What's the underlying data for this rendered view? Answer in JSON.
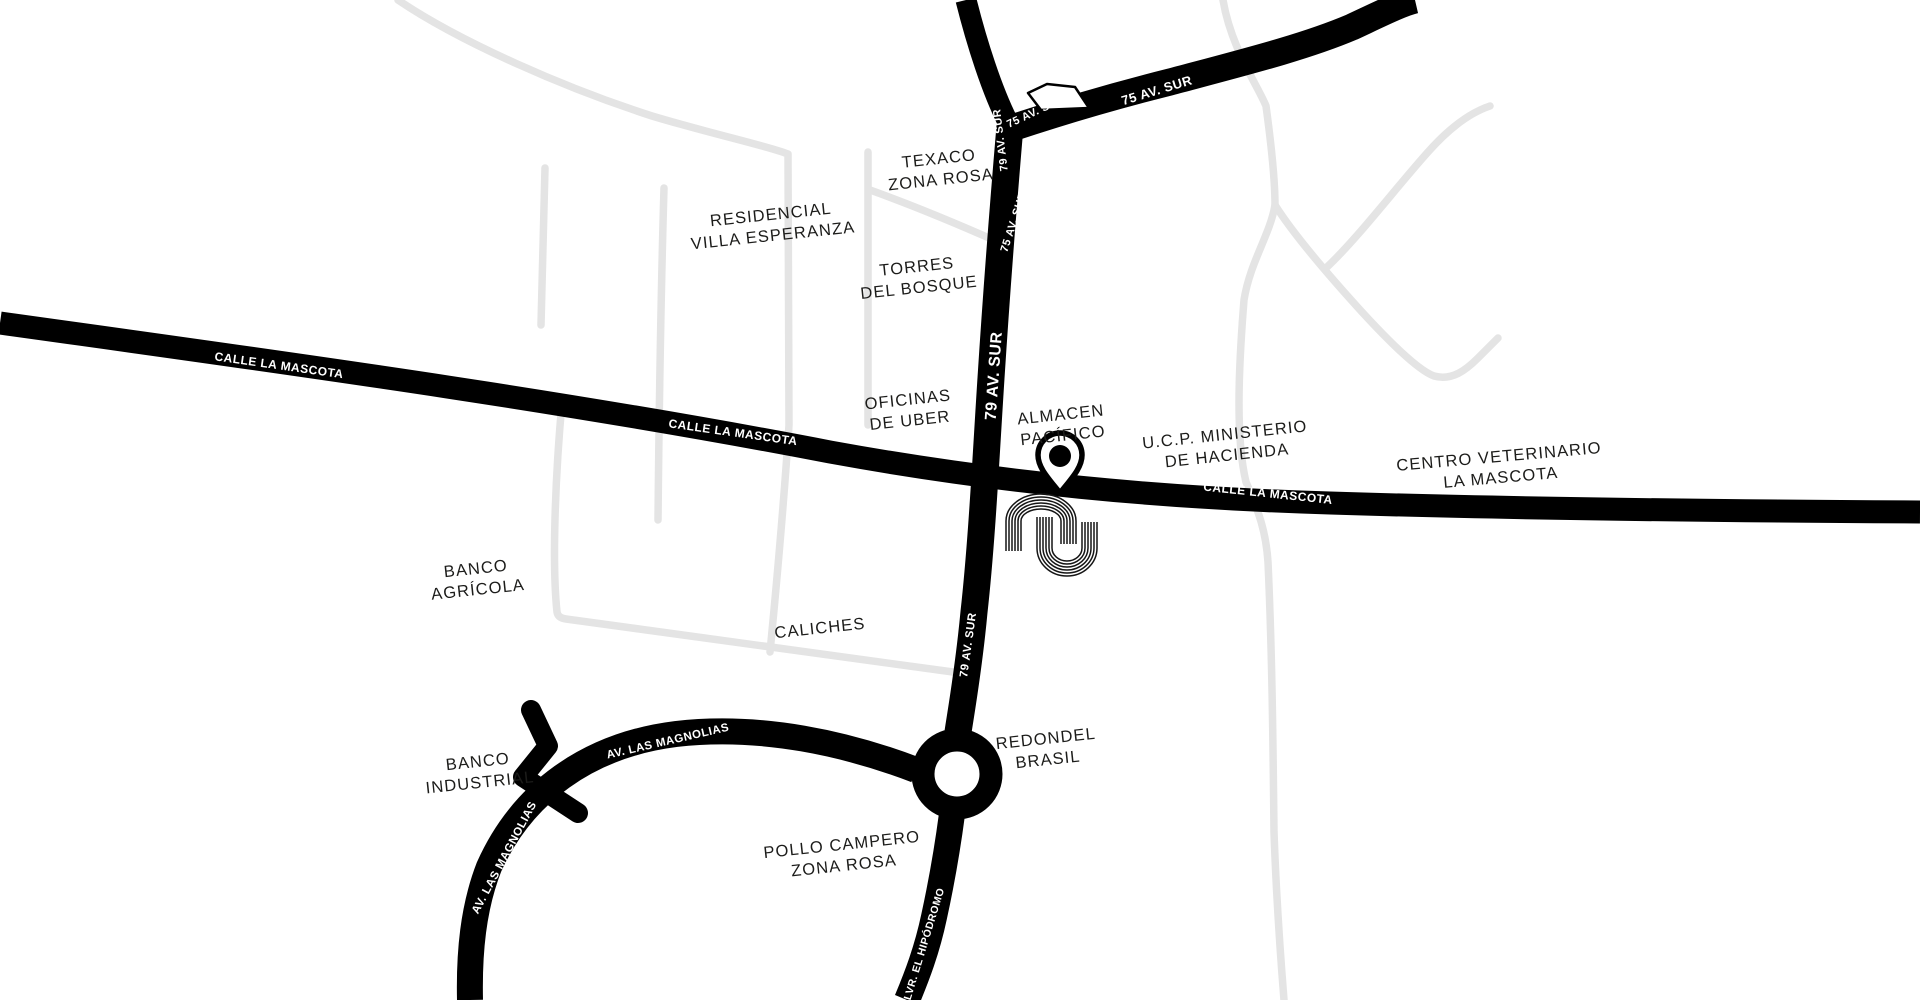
{
  "map": {
    "type": "stylized-street-map",
    "background_color": "#ffffff",
    "major_road_color": "#000000",
    "minor_road_color": "#e4e4e4",
    "place_label_color": "#1c1c1a",
    "road_label_color": "#ffffff",
    "marker": {
      "name": "location-pin",
      "x": 1060,
      "y": 456
    },
    "logo": {
      "name": "nu-wave-logo",
      "x": 1052,
      "y": 535
    },
    "roundabout": {
      "x": 957,
      "y": 774,
      "outer_radius": 46,
      "inner_radius": 23
    },
    "roads_major": [
      "CALLE LA MASCOTA",
      "79 AV. SUR",
      "75 AV. SUR",
      "AV. LAS MAGNOLIAS",
      "BLVR. EL HIPÓDROMO"
    ],
    "labels": [
      {
        "id": "label-texaco",
        "kind": "place",
        "text": "TEXACO\nZONA ROSA",
        "x": 940,
        "y": 170,
        "rot": -6,
        "size": 16.5
      },
      {
        "id": "label-residencial",
        "kind": "place",
        "text": "RESIDENCIAL\nVILLA ESPERANZA",
        "x": 772,
        "y": 226,
        "rot": -6,
        "size": 16.5
      },
      {
        "id": "label-torres-del-bosque",
        "kind": "place",
        "text": "TORRES\nDEL BOSQUE",
        "x": 918,
        "y": 278,
        "rot": -6,
        "size": 16.5
      },
      {
        "id": "label-oficinas-uber",
        "kind": "place",
        "text": "OFICINAS\nDE UBER",
        "x": 909,
        "y": 411,
        "rot": -6,
        "size": 16.5
      },
      {
        "id": "label-almacen-pacifico",
        "kind": "place",
        "text": "ALMACEN\nPACÍFICO",
        "x": 1062,
        "y": 426,
        "rot": -6,
        "size": 16.5
      },
      {
        "id": "label-ucp-hacienda",
        "kind": "place",
        "text": "U.C.P. MINISTERIO\nDE HACIENDA",
        "x": 1226,
        "y": 446,
        "rot": -6,
        "size": 16.5
      },
      {
        "id": "label-centro-veterinario",
        "kind": "place",
        "text": "CENTRO VETERINARIO\nLA MASCOTA",
        "x": 1500,
        "y": 468,
        "rot": -5,
        "size": 16.5
      },
      {
        "id": "label-banco-agricola",
        "kind": "place",
        "text": "BANCO\nAGRÍCOLA",
        "x": 477,
        "y": 580,
        "rot": -6,
        "size": 16.5
      },
      {
        "id": "label-caliches",
        "kind": "place",
        "text": "CALICHES",
        "x": 820,
        "y": 629,
        "rot": -6,
        "size": 16.5
      },
      {
        "id": "label-banco-industrial",
        "kind": "place",
        "text": "BANCO\nINDUSTRIAL",
        "x": 479,
        "y": 773,
        "rot": -6,
        "size": 16.5
      },
      {
        "id": "label-pollo-campero",
        "kind": "place",
        "text": "POLLO CAMPERO\nZONA ROSA",
        "x": 843,
        "y": 856,
        "rot": -6,
        "size": 16.5
      },
      {
        "id": "label-redondel-brasil",
        "kind": "place",
        "text": "REDONDEL\nBRASIL",
        "x": 1047,
        "y": 750,
        "rot": -6,
        "size": 16.5
      },
      {
        "id": "road-label-mascota-1",
        "kind": "road",
        "text": "CALLE LA MASCOTA",
        "x": 279,
        "y": 366,
        "rot": 8,
        "size": 12
      },
      {
        "id": "road-label-mascota-2",
        "kind": "road",
        "text": "CALLE LA MASCOTA",
        "x": 733,
        "y": 433,
        "rot": 8,
        "size": 12
      },
      {
        "id": "road-label-mascota-3",
        "kind": "road",
        "text": "CALLE LA MASCOTA",
        "x": 1268,
        "y": 494,
        "rot": 6,
        "size": 12
      },
      {
        "id": "road-label-75-east",
        "kind": "road",
        "text": "75 AV. SUR",
        "x": 1157,
        "y": 91,
        "rot": -17,
        "size": 13
      },
      {
        "id": "road-label-75-junction",
        "kind": "road",
        "text": "75 AV. SUR",
        "x": 1036,
        "y": 112,
        "rot": -25,
        "size": 11
      },
      {
        "id": "road-label-79-top",
        "kind": "road",
        "text": "79 AV. SUR",
        "x": 1001,
        "y": 140,
        "rot": -97,
        "size": 11
      },
      {
        "id": "road-label-75-south",
        "kind": "road",
        "text": "75 AV. SUR",
        "x": 1014,
        "y": 222,
        "rot": -72,
        "size": 11
      },
      {
        "id": "road-label-79-mid",
        "kind": "road",
        "text": "79 AV. SUR",
        "x": 995,
        "y": 376,
        "rot": -86,
        "size": 16
      },
      {
        "id": "road-label-79-low",
        "kind": "road",
        "text": "79 AV. SUR",
        "x": 969,
        "y": 645,
        "rot": -82,
        "size": 11.5
      },
      {
        "id": "road-label-magnolias-1",
        "kind": "road",
        "text": "AV. LAS MAGNOLIAS",
        "x": 668,
        "y": 742,
        "rot": -13,
        "size": 11.5
      },
      {
        "id": "road-label-magnolias-2",
        "kind": "road",
        "text": "AV. LAS MAGNOLIAS",
        "x": 505,
        "y": 858,
        "rot": -62,
        "size": 11.5
      },
      {
        "id": "road-label-hipodromo",
        "kind": "road",
        "text": "BLVR. EL HIPÓDROMO",
        "x": 924,
        "y": 948,
        "rot": -73,
        "size": 10.5
      }
    ]
  }
}
